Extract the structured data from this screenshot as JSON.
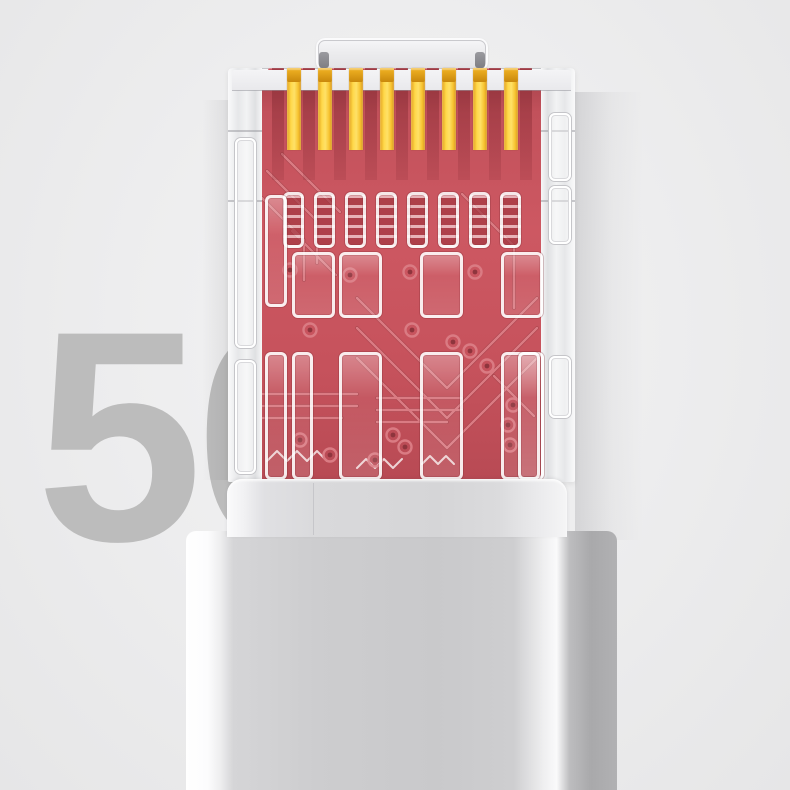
{
  "image": {
    "type": "product-photo",
    "subject": "Transparent RJ45 network plug with red circuit board and gold contacts on a white cable",
    "watermark": {
      "text": "50",
      "color": "#bcbcbc"
    },
    "background": {
      "base": "#ededee",
      "edge": "#e6e6e7"
    },
    "connector": {
      "shell_color": "#eef0f1",
      "shell_edge_color": "#c6c7ca",
      "latch_fill": "#ececee",
      "pcb_base_color": "#c6525c",
      "pcb_dark_color": "#a8434c",
      "trace_light_color": "#da7b83",
      "trace_dark_color": "#8e353d",
      "rim_tab_count": 11,
      "contact_count": 8,
      "gold_main_color": "#ffd84a",
      "gold_tip_color": "#d89a12"
    },
    "cable": {
      "boot_face_color": "#d5d5d7",
      "body_face_color": "#c9c9cb",
      "highlight_color": "#fafafb",
      "side_shade_color": "#a9a9ab"
    }
  }
}
